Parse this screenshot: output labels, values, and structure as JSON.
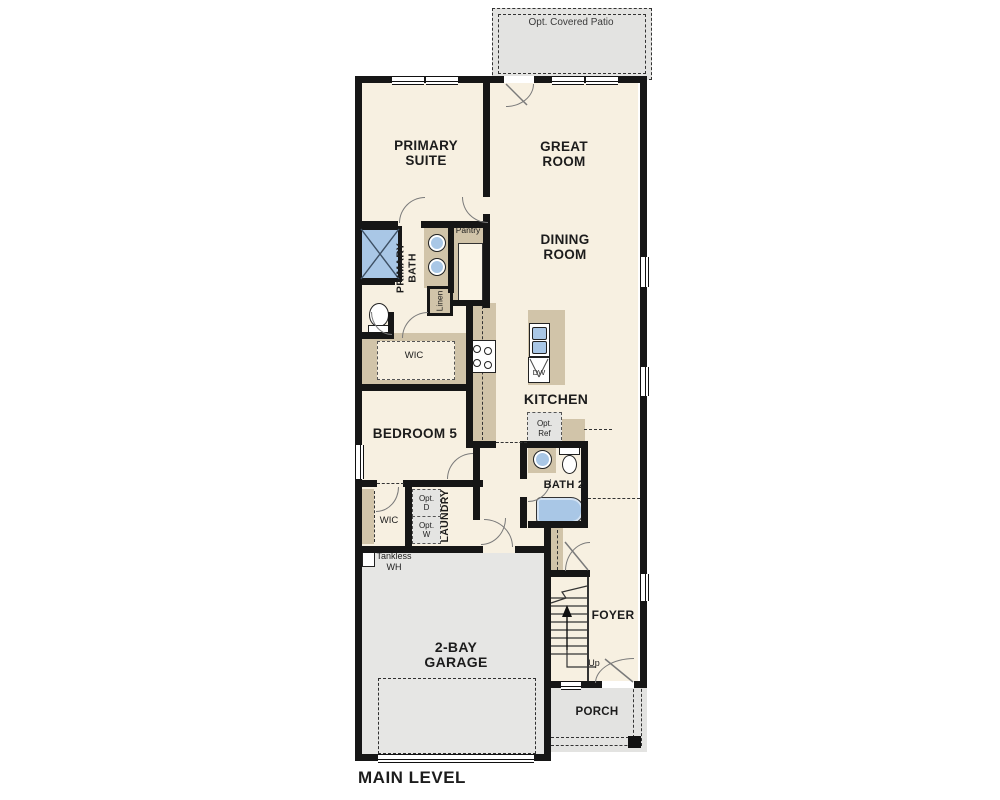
{
  "title": "MAIN LEVEL",
  "colors": {
    "wall": "#161616",
    "floor": "#f7f0e1",
    "outdoor_gray": "#e3e3e1",
    "garage_gray": "#e6e6e4",
    "counter_tan": "#d1c4a9",
    "fixture_blue": "#a9c7e6"
  },
  "labels": {
    "patio": "Opt. Covered Patio",
    "primary_suite_l1": "PRIMARY",
    "primary_suite_l2": "SUITE",
    "great_room_l1": "GREAT",
    "great_room_l2": "ROOM",
    "dining_l1": "DINING",
    "dining_l2": "ROOM",
    "primary_bath_l1": "PRIMARY",
    "primary_bath_l2": "BATH",
    "pantry": "Pantry",
    "linen": "Linen",
    "wic_primary": "WIC",
    "kitchen": "KITCHEN",
    "dw": "DW",
    "opt_ref_l1": "Opt.",
    "opt_ref_l2": "Ref",
    "bedroom5": "BEDROOM 5",
    "bath2": "BATH 2",
    "laundry": "LAUNDRY",
    "opt_d_l1": "Opt.",
    "opt_d_l2": "D",
    "opt_w_l1": "Opt.",
    "opt_w_l2": "W",
    "wic_bedroom5": "WIC",
    "tankless_l1": "Tankless",
    "tankless_l2": "WH",
    "garage_l1": "2-BAY",
    "garage_l2": "GARAGE",
    "foyer": "FOYER",
    "up": "Up",
    "porch": "PORCH",
    "main_level": "MAIN LEVEL"
  }
}
